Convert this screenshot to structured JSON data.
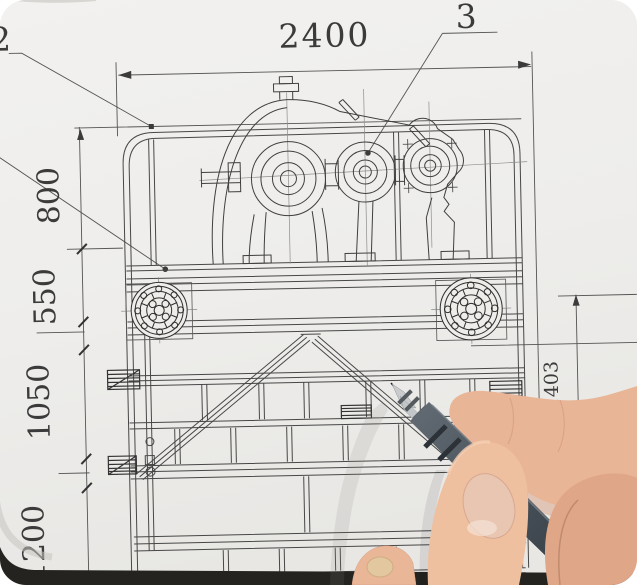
{
  "photo": {
    "scene": "hand pointing a pen at a mechanical engineering drawing of a gearbox on a screen frame",
    "paper_color": "#f0efec",
    "line_color": "#4a4a4a",
    "pen_color": "#49525a",
    "skin_color": "#e8b296",
    "photo_edge_color": "#24231f"
  },
  "dimensions": {
    "width_top": "2400",
    "left_800": "800",
    "left_550": "550",
    "left_1050": "1050",
    "left_1200": "1200",
    "right_1403": "1403"
  },
  "callouts": {
    "item_2": "2",
    "item_3": "3"
  }
}
